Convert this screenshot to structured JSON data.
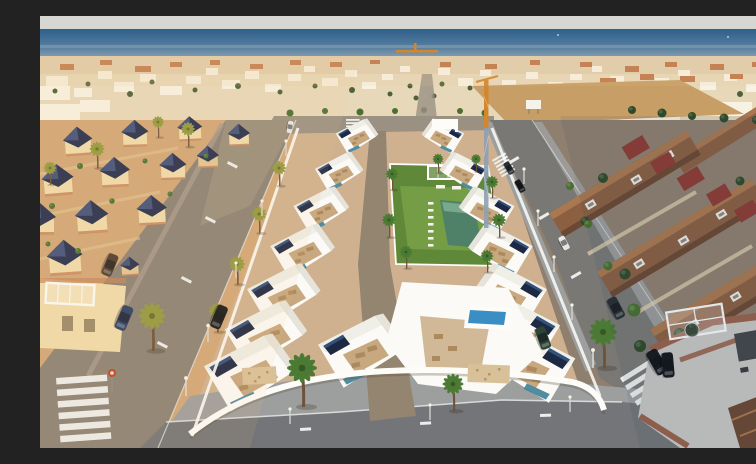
{
  "scene": {
    "type": "aerial-photograph",
    "description": "Aerial drone photograph of a coastal town: a new development of white flat-roof villas with solar panels and roof terraces arranged in two rows around a communal lawn with a pool, bordered by palm-lined streets with zebra crosswalks and parked cars; older cream villas with navy pyramid roofs on the left in golden light, terracotta-roofed townhouses on the right in shade, a dense white town beyond, a construction crane, and the blue sea meeting a pale sky at the horizon.",
    "width": 756,
    "height": 432
  },
  "palette": {
    "sky": "#d6d7d3",
    "seaDeep": "#2f5f8c",
    "seaMid": "#58809f",
    "seaHaze": "#9fb0ba",
    "townBase": "#e7d8ba",
    "townWhite": "#f8f2e3",
    "townRoof": "#c07a4e",
    "townTree": "#4f6138",
    "dirtLot": "#c79e66",
    "craneOrange": "#d2872f",
    "craneSteel": "#8fa0b0",
    "leftGround": "#d2a878",
    "leftWall": "#f0dcab",
    "leftWallDeep": "#e2c492",
    "navyRoof": "#27304f",
    "navyRoofLit": "#43527c",
    "terraTrim": "#c5845a",
    "newGround": "#cfb190",
    "newWhite": "#fbfaf6",
    "newShade": "#e6e3da",
    "terraceTan": "#c7a87f",
    "furnTan": "#ad8a5e",
    "solarNavy": "#1d2843",
    "solarBlue": "#31517e",
    "glassTeal": "#3f7f98",
    "lawn": "#5f8838",
    "lawnLit": "#79a349",
    "poolTeal": "#4e8168",
    "poolTealLit": "#78a98c",
    "poolBlue": "#3a8ec4",
    "roadLeft": "#8b8277",
    "roadRight": "#7a7874",
    "roadBottom": "#737578",
    "roadUpper": "#9a9183",
    "roadGlare": "#a89a83",
    "sidewalk": "#9d9f9f",
    "sidewalkWarm": "#ab9c8e",
    "stripe": "#eceeec",
    "innerLane": "#93856f",
    "rightGround": "#8f7f6e",
    "roofLit": "#aa7850",
    "roof": "#8c5f41",
    "roofShade": "#6b4833",
    "roofRed": "#8e3c33",
    "rightWall": "#e5d3b2",
    "brick": "#99604b",
    "patio": "#c9c8c4",
    "patioDark": "#45474a",
    "treeDark": "#2f4a28",
    "treeMid": "#49702f",
    "palmGreen": "#4a7a33",
    "palmGold": "#93993f",
    "trunk": "#6e5239",
    "carBlue": "#2d3f64",
    "carBlack": "#17181b",
    "carDark": "#2b2d31",
    "carGreen": "#2e4536",
    "carWhite": "#e9e9e7",
    "carBrown": "#4f3d2f",
    "lampPole": "#d8d8d4",
    "signRed": "#c04327",
    "wallWhite": "#fdfcf9",
    "stone": "#d8c198",
    "pergola": "#f6f4ee"
  }
}
